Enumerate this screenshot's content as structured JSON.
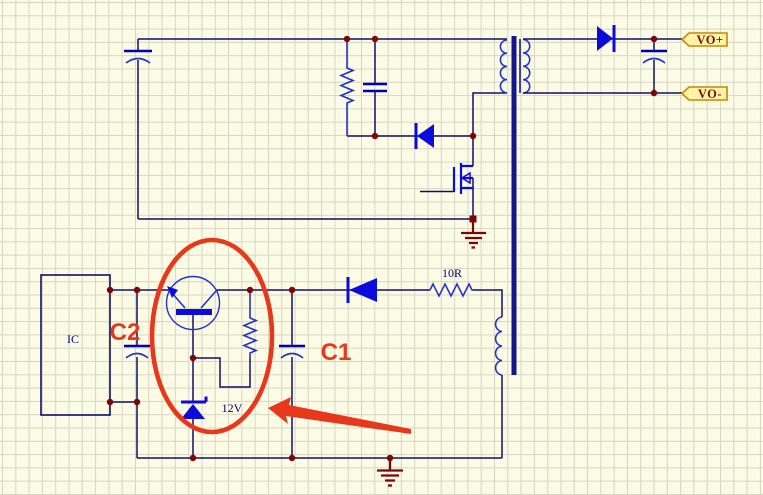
{
  "labels": {
    "ic_box": "IC",
    "aux_resistor": "10R",
    "zener_voltage": "12V"
  },
  "ports": {
    "positive": "VO+",
    "negative": "VO-"
  },
  "annotations": {
    "cap_near_ic": "C2",
    "cap_aux": "C1"
  },
  "colors": {
    "wire": "#10106a",
    "component_blue": "#2233cc",
    "fill_blue": "#0b0bdd",
    "plate_blue": "#0000b4",
    "junction_maroon": "#7c0505",
    "annotation_red": "#e8381c",
    "port_fill": "#fff3a6",
    "port_border": "#c8860a",
    "port_text": "#7a1200",
    "label_navy": "#00007a",
    "core_navy": "#16168c",
    "background": "#fbfbe6",
    "grid_line": "#d6d6c2"
  }
}
